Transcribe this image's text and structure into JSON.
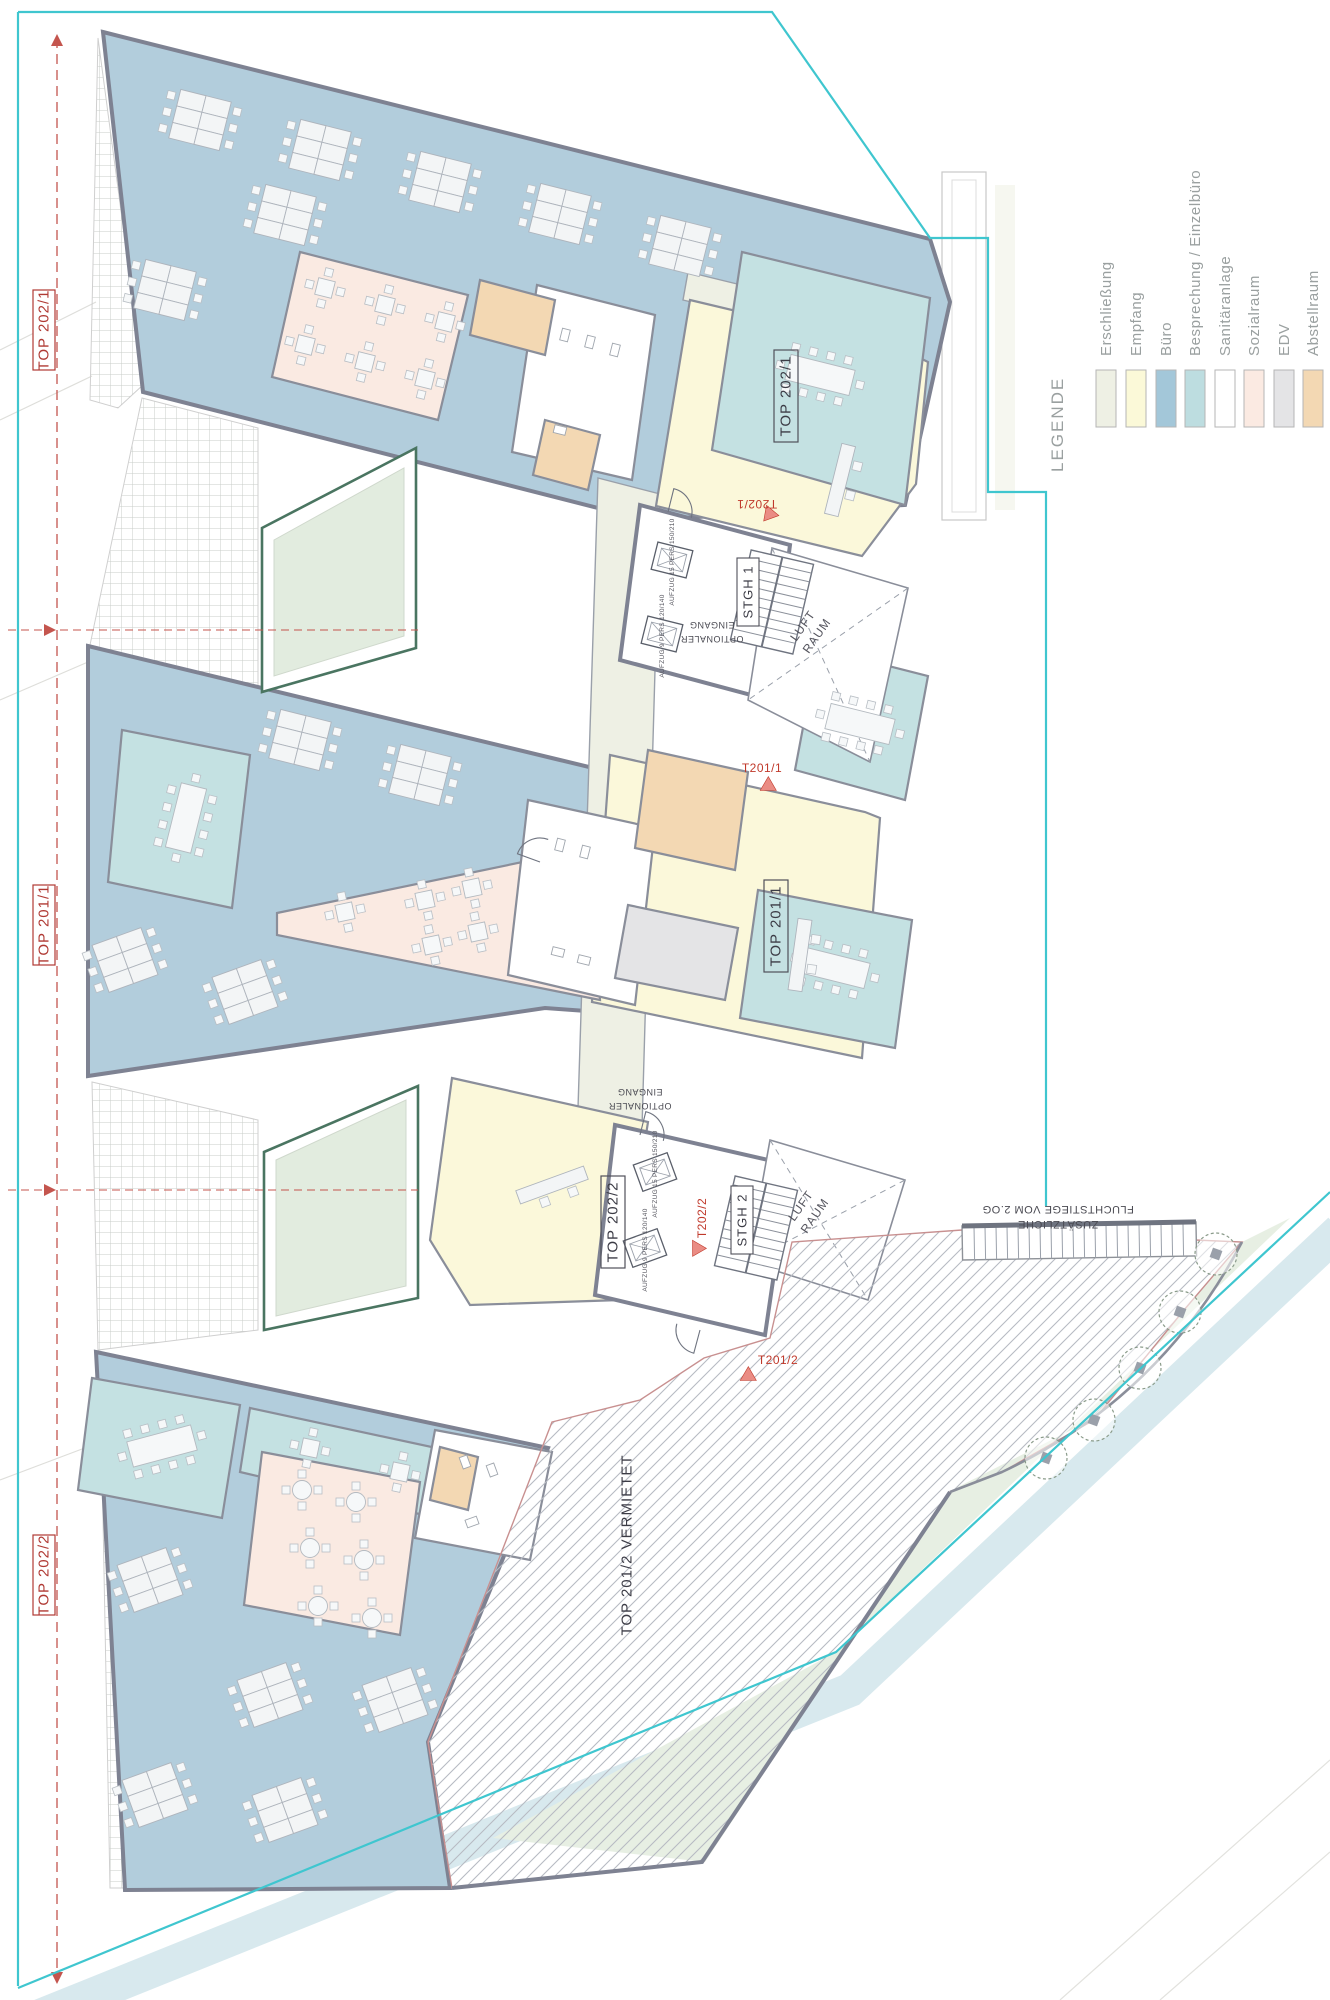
{
  "legend": {
    "title": "LEGENDE",
    "items": [
      {
        "label": "Erschließung",
        "color": "#eef0e4"
      },
      {
        "label": "Empfang",
        "color": "#fbf9d8"
      },
      {
        "label": "Büro",
        "color": "#a3c7d9"
      },
      {
        "label": "Besprechung / Einzelbüro",
        "color": "#bddde0"
      },
      {
        "label": "Sanitäranlage",
        "color": "#ffffff"
      },
      {
        "label": "Sozialraum",
        "color": "#fbeae2"
      },
      {
        "label": "EDV",
        "color": "#e4e4e6"
      },
      {
        "label": "Abstellraum",
        "color": "#f3d8b3"
      }
    ]
  },
  "site": {
    "boundary_color": "#3fc6cf",
    "section_line_color": "#c4554e"
  },
  "units": {
    "top": "TOP 202/1",
    "middle": "TOP 201/1",
    "lower": "TOP 202/2",
    "rented": "TOP 201/2 VERMIETET"
  },
  "cores": {
    "stair1": "STGH 1",
    "stair2": "STGH 2",
    "void_line1": "LUFT",
    "void_line2": "RAUM",
    "elevator_large": "AUFZUG 15 PERS 150/210",
    "elevator_small": "AUFZUG 9 PERS 120/140"
  },
  "annotations": {
    "optional_entrance_line1": "OPTIONALER",
    "optional_entrance_line2": "EINGANG",
    "escape_line1": "ZUSÄTZLICHE",
    "escape_line2": "FLUCHTSTIEGE VOM 2.OG",
    "door_top": "T202/1",
    "door_mid": "T201/1",
    "door_lower": "T202/2",
    "door_bottom": "T201/2"
  }
}
